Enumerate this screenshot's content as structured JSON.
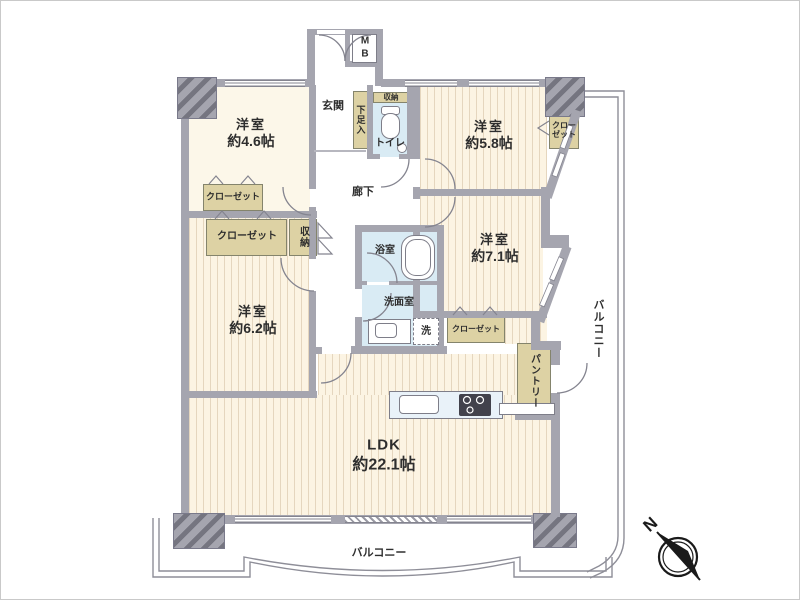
{
  "rooms": {
    "bedroom_4_6": {
      "name": "洋室",
      "size": "約4.6帖"
    },
    "bedroom_5_8": {
      "name": "洋室",
      "size": "約5.8帖"
    },
    "bedroom_7_1": {
      "name": "洋室",
      "size": "約7.1帖"
    },
    "bedroom_6_2": {
      "name": "洋室",
      "size": "約6.2帖"
    },
    "ldk": {
      "name": "LDK",
      "size": "約22.1帖"
    },
    "entrance": "玄関",
    "hallway": "廊下",
    "bathroom": "浴室",
    "washroom": "洗面室",
    "toilet": "トイレ",
    "meter_box": "MB"
  },
  "storage": {
    "closet": "クローゼット",
    "storage": "収納",
    "shoe_box": "下足入",
    "pantry": "パントリー",
    "washer": "洗"
  },
  "balcony": {
    "bottom": "バルコニー",
    "right": "バルコニー"
  },
  "compass": {
    "north": "N"
  },
  "colors": {
    "wall": "#a5a5af",
    "floor_wood": "#fcf4e3",
    "floor_plain": "#fcf7e9",
    "water_area": "#d9ebf4",
    "storage_tan": "#ddd2a4",
    "line": "#84848f"
  }
}
